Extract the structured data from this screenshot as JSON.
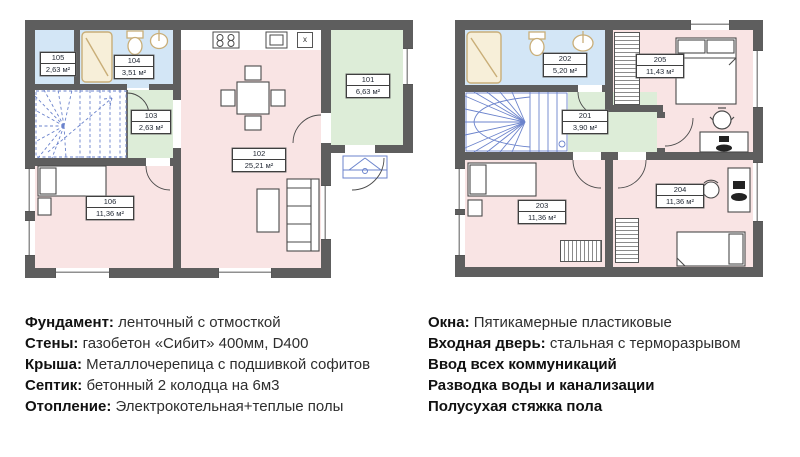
{
  "plan1": {
    "rooms": [
      {
        "number": "105",
        "area": "2,63 м²"
      },
      {
        "number": "104",
        "area": "3,51 м²"
      },
      {
        "number": "103",
        "area": "2,63 м²"
      },
      {
        "number": "102",
        "area": "25,21 м²"
      },
      {
        "number": "101",
        "area": "6,63 м²"
      },
      {
        "number": "106",
        "area": "11,36 м²"
      }
    ],
    "kitchen_unit_label": "x"
  },
  "plan2": {
    "rooms": [
      {
        "number": "202",
        "area": "5,20 м²"
      },
      {
        "number": "201",
        "area": "3,90 м²"
      },
      {
        "number": "205",
        "area": "11,43 м²"
      },
      {
        "number": "203",
        "area": "11,36 м²"
      },
      {
        "number": "204",
        "area": "11,36 м²"
      }
    ]
  },
  "specs_left": [
    {
      "label": "Фундамент:",
      "value": "ленточный с отмосткой"
    },
    {
      "label": "Стены:",
      "value": "газобетон «Сибит» 400мм, D400"
    },
    {
      "label": "Крыша:",
      "value": "Металлочерепица с подшивкой софитов"
    },
    {
      "label": "Септик:",
      "value": "бетонный 2 колодца на 6м3"
    },
    {
      "label": "Отопление:",
      "value": "Электрокотельная+теплые полы"
    }
  ],
  "specs_right": [
    {
      "label": "Окна:",
      "value": "Пятикамерные пластиковые"
    },
    {
      "label": "Входная дверь:",
      "value": "стальная с терморазрывом"
    },
    {
      "label": "Ввод всех коммуникаций",
      "value": ""
    },
    {
      "label": "Разводка воды и канализации",
      "value": ""
    },
    {
      "label": "Полусухая стяжка пола",
      "value": ""
    }
  ],
  "colors": {
    "wall": "#5e5e5e",
    "room_pink": "#f9e4e4",
    "room_green": "#ddedd8",
    "room_blue": "#d3e6f6",
    "stair_blue": "#6b83cc",
    "fixture_tan": "#c9ae78"
  }
}
